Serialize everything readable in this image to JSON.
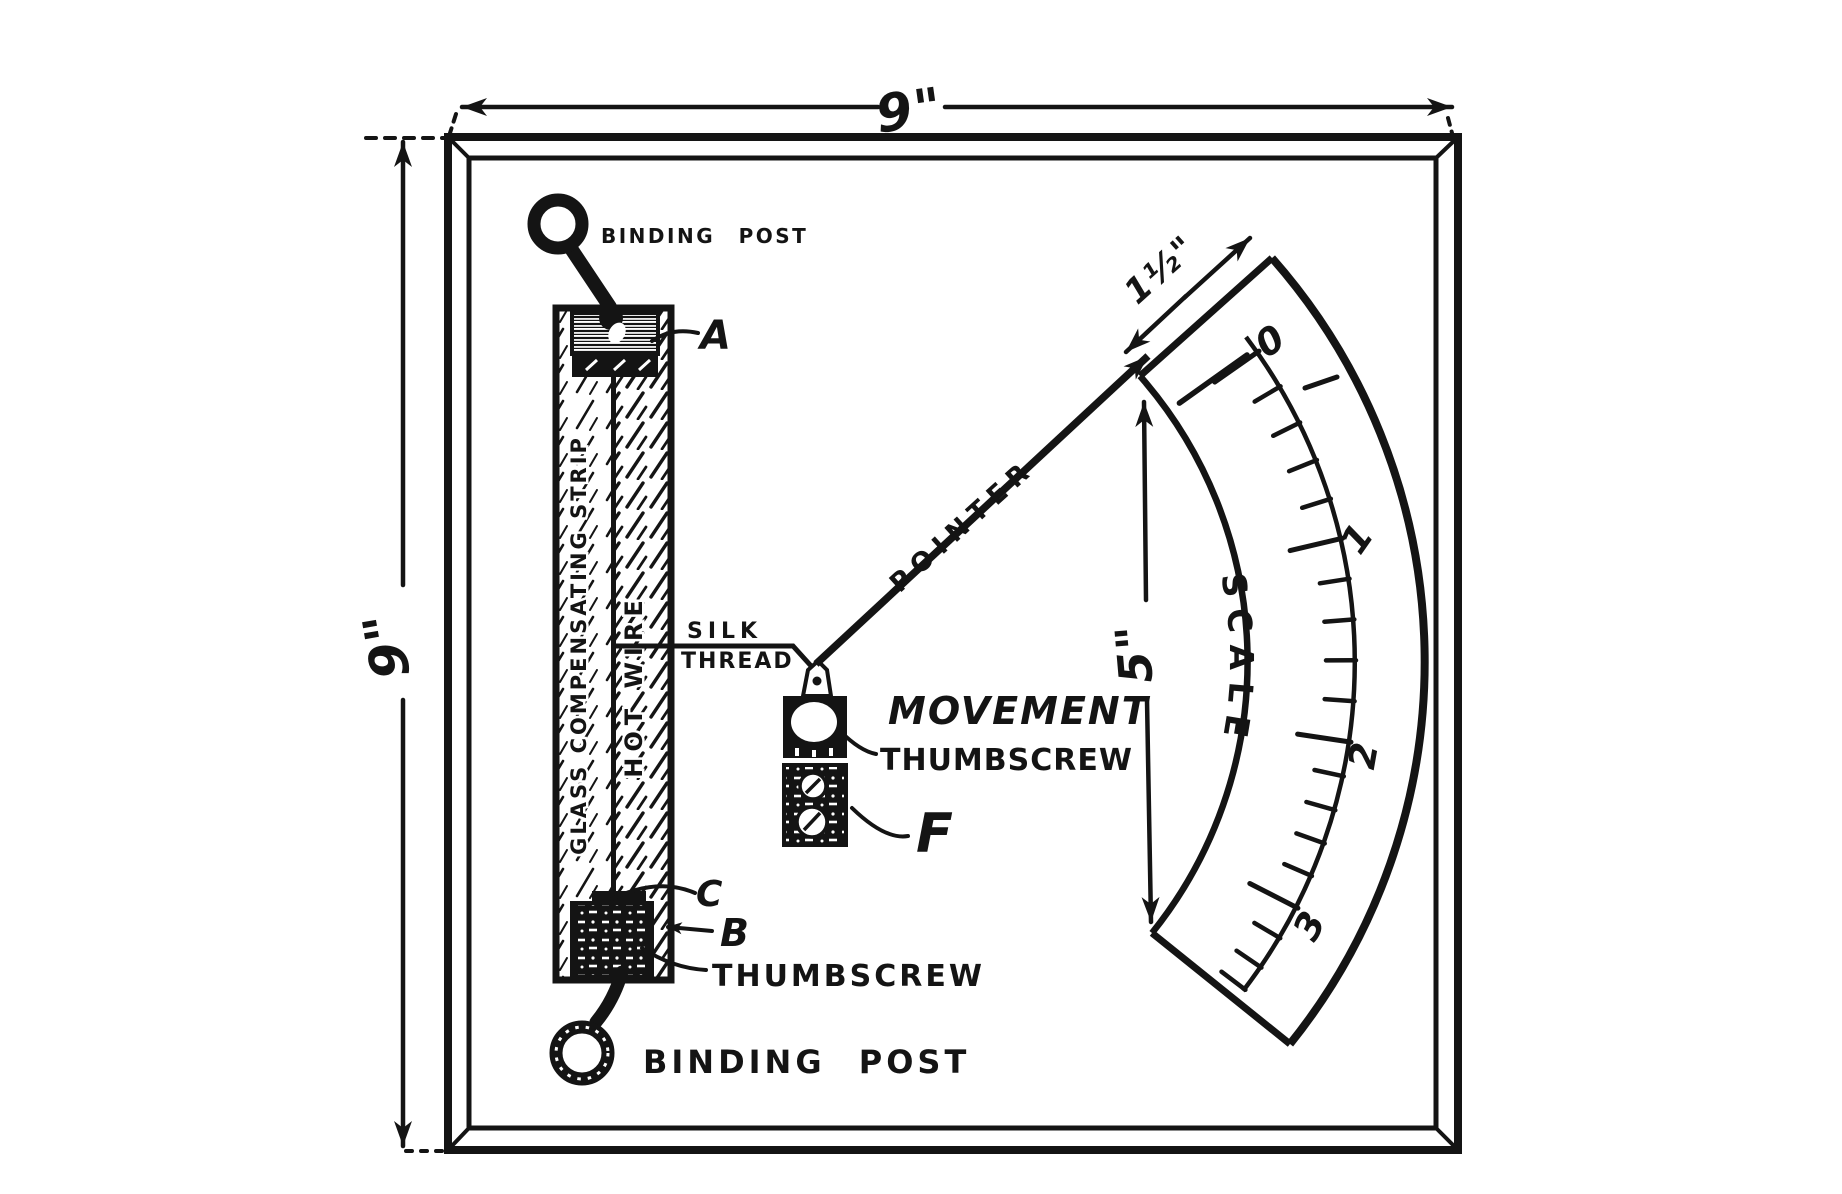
{
  "ink": "#141414",
  "paper": "#ffffff",
  "dimensions": {
    "board_width": "9\"",
    "board_height": "9\"",
    "scale_top_edge": "1½\"",
    "scale_span": "5\""
  },
  "posts": {
    "top_label": "BINDING POST",
    "bottom_label": "BINDING POST"
  },
  "strip": {
    "glass_label": "GLASS COMPENSATING STRIP",
    "hot_wire_label": "HOT WIRE",
    "clamp_top_letter": "A",
    "clamp_plate_letter": "C",
    "clamp_bottom_letter": "B",
    "thumbscrew_label": "THUMBSCREW"
  },
  "movement": {
    "silk_label_line1": "SILK",
    "silk_label_line2": "THREAD",
    "pointer_label": "POINTER",
    "name_label": "MOVEMENT",
    "thumbscrew_label": "THUMBSCREW",
    "frame_letter": "F"
  },
  "scale": {
    "name_label": "SCALE",
    "numerals": [
      "0",
      "1",
      "2",
      "3"
    ],
    "geometry": {
      "cx": 815,
      "cy": 662,
      "radius": 540,
      "major_angles": [
        -35,
        -13.2,
        8.5,
        27
      ],
      "subdivisions": 5,
      "extra_minor_angles": [
        30.7,
        34.4,
        37.3
      ],
      "major_len": 52,
      "minor_len": 29,
      "zero_tick": {
        "r1": 530,
        "r2": 447,
        "angle": -35.4
      }
    }
  }
}
